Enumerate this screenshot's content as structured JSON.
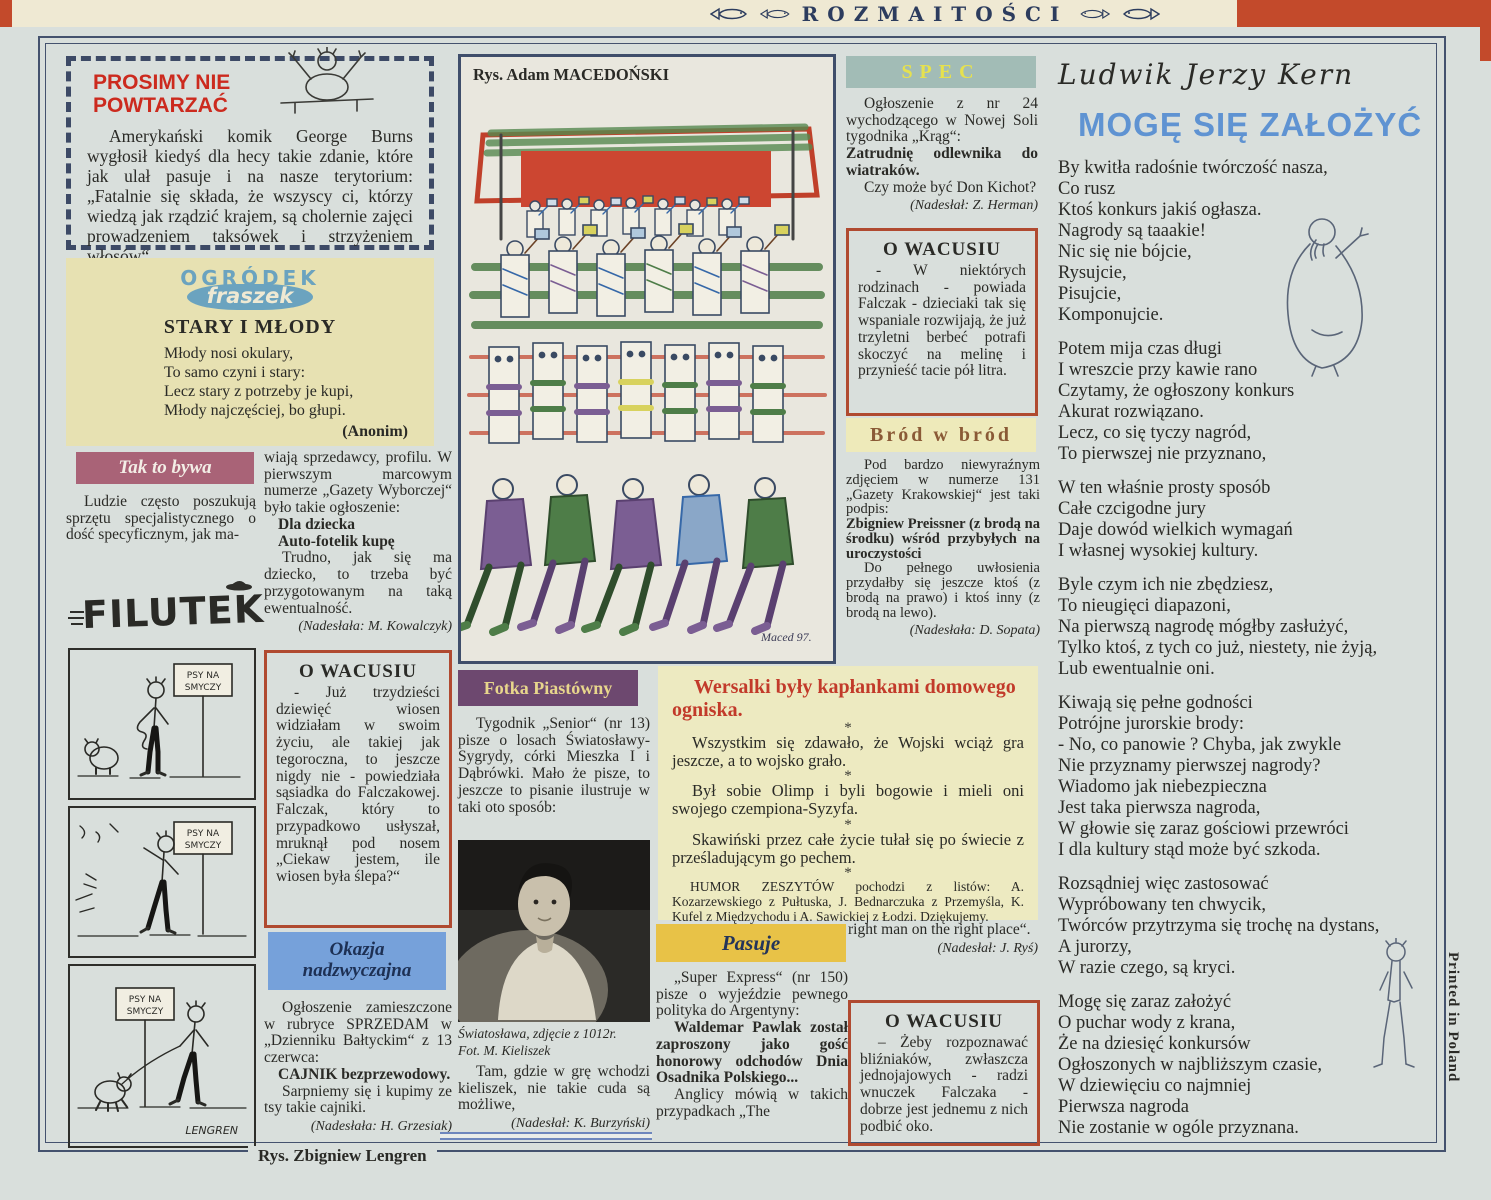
{
  "banner": {
    "title": "ROZMAITOŚCI"
  },
  "page": {
    "printed": "Printed in Poland",
    "bottom_caption": "Rys. Zbigniew Lengren"
  },
  "prosimy": {
    "title1": "PROSIMY NIE",
    "title2": "POWTARZAĆ",
    "body": "Amerykański komik George Burns wygłosił kiedyś dla hecy takie zdanie, które jak ulał pasuje i na nasze terytorium: „Fatalnie się składa, że wszyscy ci, którzy wiedzą jak rządzić krajem, są cholernie zajęci prowadzeniem taksówek i strzyżeniem włosów“."
  },
  "fraszek": {
    "logo1": "OGRÓDEK",
    "logo2": "fraszek",
    "title": "STARY I MŁODY",
    "lines": [
      "Młody nosi okulary,",
      "To samo czyni i stary:",
      "Lecz stary z potrzeby je kupi,",
      "Młody najczęściej, bo głupi."
    ],
    "author": "(Anonim)"
  },
  "tak": {
    "header": "Tak to bywa",
    "body": "Ludzie często poszukują sprzętu specjalistycznego o dość specyficznym, jak ma-"
  },
  "filutek": {
    "logo": "FILUTEK"
  },
  "comic": {
    "sign1": "PSY NA",
    "sign2": "SMYCZY",
    "signature": "LENGREN"
  },
  "col2": {
    "continuation": "wiają sprzedawcy, profilu. W pierwszym marcowym numerze „Gazety Wyborczej“ było takie ogłoszenie:",
    "ad1": "Dla dziecka",
    "ad2": "Auto-fotelik kupę",
    "comment": "Trudno, jak się ma dziecko, to trzeba być przygotowanym na taką ewentualność.",
    "credit": "(Nadesłała: M. Kowalczyk)"
  },
  "wacusiu1": {
    "title": "O WACUSIU",
    "body": "- Już trzydzieści dziewięć wiosen widziałam w swoim życiu, ale takiej jak tegoroczna, to jeszcze nigdy nie - powiedziała sąsiadka do Falczakowej. Falczak, który to przypadkowo usłyszał, mruknął pod nosem „Ciekaw jestem, ile wiosen była ślepa?“"
  },
  "okazja": {
    "header1": "Okazja",
    "header2": "nadzwyczajna",
    "body": "Ogłoszenie zamieszczone w rubryce SPRZEDAM w „Dzienniku Bałtyckim“ z 13 czerwca:",
    "ad": "CAJNIK bezprzewodowy.",
    "comment": "Sarpniemy się i kupimy ze tsy takie cajniki.",
    "credit": "(Nadesłała: H. Grzesiak)"
  },
  "drawing": {
    "caption": "Rys. Adam MACEDOŃSKI",
    "signature": "Maced 97."
  },
  "fotka": {
    "header": "Fotka Piastówny",
    "body": "Tygodnik „Senior“ (nr 13) pisze o losach Światosławy-Sygrydy, córki Mieszka I i Dąbrówki. Mało że pisze, to jeszcze to pisanie ilustruje w taki oto sposób:",
    "photo_caption": [
      "Światosława, zdjęcie z 1012r.",
      "Fot. M. Kieliszek"
    ],
    "after": "Tam, gdzie w grę wchodzi kieliszek, nie takie cuda są możliwe,",
    "credit": "(Nadesłał: K. Burzyński)"
  },
  "wersalki": {
    "title": "Wersalki były kapłankami domowego ogniska.",
    "star": "*",
    "items": [
      "Wszystkim się zdawało, że Wojski wciąż gra jeszcze, a to wojsko grało.",
      "Był sobie Olimp i byli bogowie i mieli oni swojego czempiona-Syzyfa.",
      "Skawiński przez całe życie tułał się po świecie z prześladującym go pechem."
    ],
    "footer": "HUMOR ZESZYTÓW pochodzi z listów: A. Kozarzewskiego z Pułtuska, J. Bednarczuka z Przemyśla, K. Kufel z Międzychodu i A. Sawickiej z Łodzi. Dziękujemy."
  },
  "pasuje": {
    "header": "Pasuje",
    "body": "„Super Express“ (nr 150) pisze o wyjeździe pewnego polityka do Argentyny:",
    "bold": "Waldemar Pawlak został zaproszony jako gość honorowy odchodów Dnia Osadnika Polskiego...",
    "after": "Anglicy mówią w takich przypadkach „The"
  },
  "pasuje_end": {
    "text": "right man on the right place“.",
    "credit": "(Nadesłał: J. Ryś)"
  },
  "spec": {
    "header": "SPEC",
    "body": "Ogłoszenie z nr 24 wychodzącego w Nowej Soli tygodnika „Krąg“:",
    "bold": "Zatrudnię odlewnika do wiatraków.",
    "after": "Czy może być Don Kichot?",
    "credit": "(Nadesłał: Z. Herman)"
  },
  "wacusiu2": {
    "title": "O WACUSIU",
    "body": "- W niektórych rodzinach - powiada Falczak - dzieciaki tak się wspaniale rozwijają, że już trzyletni berbeć potrafi skoczyć na melinę i przynieść tacie pół litra."
  },
  "brod": {
    "header": "Bród w bród",
    "body": "Pod bardzo niewyraźnym zdjęciem w numerze 131 „Gazety Krakowskiej“ jest taki podpis:",
    "bold": "Zbigniew Preissner (z brodą na środku) wśród przybyłych na uroczystości",
    "after": "Do pełnego uwłosienia przydałby się jeszcze ktoś (z brodą na prawo) i ktoś inny (z brodą na lewo).",
    "credit": "(Nadesłała: D. Sopata)"
  },
  "wacusiu3": {
    "title": "O WACUSIU",
    "body": "– Żeby rozpoznawać bliźniaków, zwłaszcza jednojajowych - radzi wnuczek Falczaka - dobrze jest jednemu z nich podbić oko."
  },
  "poem": {
    "author": "Ludwik Jerzy Kern",
    "title": "MOGĘ SIĘ ZAŁOŻYĆ",
    "stanzas": [
      [
        "By kwitła radośnie twórczość nasza,",
        "Co rusz",
        "Ktoś konkurs jakiś ogłasza.",
        "Nagrody są taaakie!",
        "Nic się nie bójcie,",
        "Rysujcie,",
        "Pisujcie,",
        "Komponujcie."
      ],
      [
        "Potem mija czas długi",
        "I wreszcie przy kawie rano",
        "Czytamy, że ogłoszony konkurs",
        "Akurat rozwiązano.",
        "Lecz, co się tyczy nagród,",
        "To pierwszej nie przyznano,"
      ],
      [
        "W ten właśnie prosty sposób",
        "Całe czcigodne jury",
        "Daje dowód wielkich wymagań",
        "I własnej wysokiej  kultury."
      ],
      [
        "Byle czym ich nie zbędziesz,",
        "To nieugięci diapazoni,",
        "Na pierwszą nagrodę mógłby  zasłużyć,",
        "Tylko ktoś, z tych co już, niestety, nie żyją,",
        "Lub ewentualnie oni."
      ],
      [
        "Kiwają się pełne godności",
        "Potrójne jurorskie brody:",
        "- No, co panowie ? Chyba, jak zwykle",
        "Nie przyznamy pierwszej nagrody?",
        "Wiadomo jak niebezpieczna",
        "Jest taka pierwsza nagroda,",
        "W głowie się zaraz gościowi przewróci",
        "I dla kultury stąd  może być szkoda."
      ],
      [
        "Rozsądniej więc zastosować",
        "Wypróbowany ten chwycik,",
        "Twórców przytrzyma się trochę na dystans,",
        "A jurorzy,",
        "W razie czego, są kryci."
      ],
      [
        "Mogę się  zaraz założyć",
        "O puchar wody z krana,",
        "Że na dziesięć konkursów",
        "Ogłoszonych  w najbliższym czasie,",
        "W dziewięciu co najmniej",
        "Pierwsza nagroda",
        "Nie  zostanie w ogóle przyznana."
      ]
    ]
  }
}
